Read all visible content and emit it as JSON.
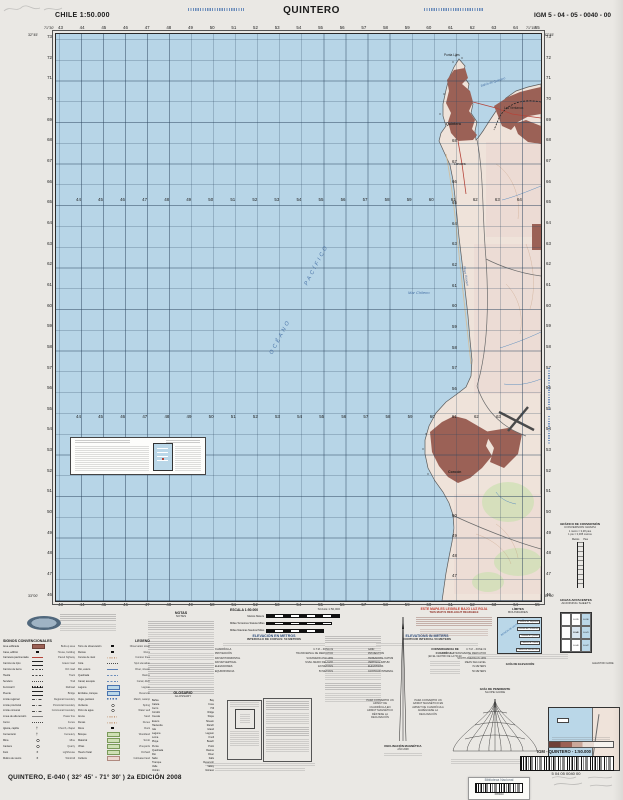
{
  "header": {
    "left": "CHILE  1:50.000",
    "title": "QUINTERO",
    "right": "IGM 5 - 04 - 05 - 0040 - 00"
  },
  "corners": {
    "lon_w": "71°30'",
    "lon_e": "71°15'",
    "lat_n": "32°45'",
    "lat_s": "33°00'"
  },
  "grid": {
    "top": [
      "43",
      "44",
      "45",
      "46",
      "47",
      "48",
      "49",
      "50",
      "51",
      "52",
      "53",
      "54",
      "55",
      "56",
      "57",
      "58",
      "59",
      "60",
      "61",
      "62",
      "63",
      "64",
      "65"
    ],
    "bottom": [
      "43",
      "44",
      "45",
      "46",
      "47",
      "48",
      "49",
      "50",
      "51",
      "52",
      "53",
      "54",
      "55",
      "56",
      "57",
      "58",
      "59",
      "60",
      "61",
      "62",
      "63",
      "64",
      "65"
    ],
    "left": [
      "73",
      "72",
      "71",
      "70",
      "69",
      "68",
      "67",
      "66",
      "65",
      "64",
      "63",
      "62",
      "61",
      "60",
      "59",
      "58",
      "57",
      "56",
      "55",
      "54",
      "53",
      "52",
      "51",
      "50",
      "49",
      "48",
      "47",
      "46"
    ],
    "right": [
      "73",
      "72",
      "71",
      "70",
      "69",
      "68",
      "67",
      "66",
      "65",
      "64",
      "63",
      "62",
      "61",
      "60",
      "59",
      "58",
      "57",
      "56",
      "55",
      "54",
      "53",
      "52",
      "51",
      "50",
      "49",
      "48",
      "47",
      "46"
    ],
    "inner_row1": [
      "44",
      "45",
      "46",
      "47",
      "48",
      "49",
      "50",
      "51",
      "52",
      "53",
      "54",
      "55",
      "56",
      "57",
      "58",
      "59",
      "60",
      "61",
      "62",
      "63",
      "64"
    ],
    "inner_row2": [
      "44",
      "45",
      "46",
      "47",
      "48",
      "49",
      "50",
      "51",
      "52",
      "53",
      "54",
      "55",
      "56",
      "57",
      "58",
      "59",
      "60",
      "61",
      "62",
      "63"
    ],
    "inner_col_a": [
      "68",
      "67",
      "66",
      "65",
      "64",
      "63",
      "62",
      "61",
      "60",
      "59",
      "58",
      "57",
      "56"
    ],
    "inner_col_b": [
      "50",
      "49",
      "48",
      "47"
    ]
  },
  "map_labels": [
    {
      "t": "OCÉANO",
      "cls": "lbl-ocean",
      "style": "left:205px;top:300px;transform:rotate(-62deg);"
    },
    {
      "t": "PACÍFICO",
      "cls": "lbl-ocean",
      "style": "left:238px;top:228px;transform:rotate(-62deg);"
    },
    {
      "t": "Mar Chileno",
      "cls": "lbl-sea",
      "style": "left:352px;top:256px;"
    },
    {
      "t": "Punta Liles",
      "cls": "",
      "style": "left:388px;top:19px;"
    },
    {
      "t": "Bahía de Quintero",
      "cls": "lbl-bay",
      "style": "left:424px;top:46px;transform:rotate(-18deg);"
    },
    {
      "t": "Quintero",
      "cls": "lbl-town",
      "style": "left:390px;top:88px;"
    },
    {
      "t": "Las Ventanas",
      "cls": "",
      "style": "left:448px;top:72px;"
    },
    {
      "t": "Loncura",
      "cls": "",
      "style": "left:398px;top:128px;"
    },
    {
      "t": "Playa Ritoque",
      "cls": "lbl-bay",
      "style": "left:400px;top:240px;transform:rotate(80deg);"
    },
    {
      "t": "Concón",
      "cls": "lbl-town",
      "style": "left:392px;top:436px;"
    }
  ],
  "colors": {
    "ocean": "#b7d5e7",
    "land": "#efe3da",
    "urban": "#9b6156",
    "green": "#cfe0b5",
    "red_note": "#c23b2e",
    "blue_text": "#4a74b0"
  },
  "notas": {
    "es": "NOTAS",
    "en": "NOTES"
  },
  "scale": {
    "es": "ESCALA 1:50.000",
    "en": "SCALE 1:50,000",
    "bar1": "Metros   Meters",
    "bar2": "Millas Terrestres   Statute Miles",
    "bar3": "Millas Náuticas   Nautical Miles"
  },
  "elev": {
    "es": "ELEVACIÓN EN METROS",
    "en": "ELEVATIONS IN METERS",
    "int_es": "INTERVALO DE CURVAS: 50 METROS",
    "int_en": "CONTOUR INTERVAL 50 METERS"
  },
  "tech_es": [
    {
      "k": "CUADRÍCULA",
      "v": "U.T.M. - ZONA 19"
    },
    {
      "k": "PROYECCIÓN",
      "v": "TRANSVERSAL DE MERCATOR"
    },
    {
      "k": "DATUM HORIZONTAL",
      "v": "SUDAMERICANO 1969"
    },
    {
      "k": "DATUM VERTICAL",
      "v": "NIVEL MEDIO DEL MAR"
    },
    {
      "k": "ELEVACIONES",
      "v": "EN METROS"
    },
    {
      "k": "EQUIDISTANCIA",
      "v": "50 METROS"
    }
  ],
  "tech_en": [
    {
      "k": "GRID",
      "v": "U.T.M. - ZONE 19"
    },
    {
      "k": "PROJECTION",
      "v": "TRANSVERSE MERCATOR"
    },
    {
      "k": "HORIZONTAL DATUM",
      "v": "SOUTH AMERICAN 1969"
    },
    {
      "k": "VERTICAL DATUM",
      "v": "MEAN SEA LEVEL"
    },
    {
      "k": "ELEVATIONS",
      "v": "IN METERS"
    },
    {
      "k": "CONTOUR INTERVAL",
      "v": "50 METERS"
    }
  ],
  "legend": {
    "es": "SIGNOS CONVENCIONALES",
    "en": "LEGEND",
    "col1": [
      {
        "l": "Área edificada",
        "s": "sy-urb",
        "r": "Built-up area"
      },
      {
        "l": "Casa, edificio",
        "s": "sy-blk",
        "r": "House, building"
      },
      {
        "l": "Carretera pavimentada",
        "s": "sy-red",
        "r": "Paved highway"
      },
      {
        "l": "Camino de ripio",
        "s": "sy-dual",
        "r": "Gravel road"
      },
      {
        "l": "Camino de tierra",
        "s": "sy-dash",
        "r": "Dirt road"
      },
      {
        "l": "Huella",
        "s": "sy-dash",
        "r": "Track"
      },
      {
        "l": "Sendero",
        "s": "sy-dot",
        "r": "Trail"
      },
      {
        "l": "Ferrocarril",
        "s": "sy-rail",
        "r": "Railroad"
      },
      {
        "l": "Puente",
        "s": "sy-dual",
        "r": "Bridge"
      },
      {
        "l": "Límite regional",
        "s": "sy-bound",
        "r": "Regional boundary"
      },
      {
        "l": "Límite provincial",
        "s": "sy-bound",
        "r": "Provincial boundary"
      },
      {
        "l": "Límite comunal",
        "s": "sy-bound",
        "r": "Communal boundary"
      },
      {
        "l": "Línea de alta tensión",
        "s": "sy-power",
        "r": "Power line"
      },
      {
        "l": "Cerco",
        "s": "sy-dot",
        "r": "Fence"
      },
      {
        "l": "Iglesia, capilla",
        "s": "sy-cross",
        "r": "Church, chapel"
      },
      {
        "l": "Cementerio",
        "s": "sy-cross",
        "r": "Cemetery"
      },
      {
        "l": "Mina",
        "s": "sy-circ",
        "r": "Mine"
      },
      {
        "l": "Cantera",
        "s": "sy-circ",
        "r": "Quarry"
      },
      {
        "l": "Faro",
        "s": "sy-star",
        "r": "Lighthouse"
      },
      {
        "l": "Molino de viento",
        "s": "sy-star",
        "r": "Windmill"
      }
    ],
    "col2": [
      {
        "l": "Torre de observación",
        "s": "sy-blk",
        "r": "Observation tower"
      },
      {
        "l": "Ruinas",
        "s": "sy-blk",
        "r": "Ruins"
      },
      {
        "l": "Curvas de nivel",
        "s": "sy-sand",
        "r": "Contour lines"
      },
      {
        "l": "Cota",
        "s": "sy-dot",
        "r": "Spot elevation"
      },
      {
        "l": "Río, estero",
        "s": "sy-blue",
        "r": "River, stream"
      },
      {
        "l": "Quebrada",
        "s": "sy-bldash",
        "r": "Ravine"
      },
      {
        "l": "Canal, acequia",
        "s": "sy-bldash",
        "r": "Canal, ditch"
      },
      {
        "l": "Laguna",
        "s": "sy-lake",
        "r": "Lagoon"
      },
      {
        "l": "Embalse, tranque",
        "s": "sy-lake",
        "r": "Reservoir"
      },
      {
        "l": "Vega, pantano",
        "s": "sy-marsh",
        "r": "Marsh, swamp"
      },
      {
        "l": "Vertiente",
        "s": "sy-circ",
        "r": "Spring"
      },
      {
        "l": "Pozo de agua",
        "s": "sy-circ",
        "r": "Water well"
      },
      {
        "l": "Arena",
        "s": "sy-sand",
        "r": "Sand"
      },
      {
        "l": "Dunas",
        "s": "sy-sand",
        "r": "Dunes"
      },
      {
        "l": "Roca",
        "s": "sy-blk",
        "r": "Rock"
      },
      {
        "l": "Bosque",
        "s": "sy-green",
        "r": "Woodland"
      },
      {
        "l": "Matorral",
        "s": "sy-green",
        "r": "Scrub"
      },
      {
        "l": "Viñas",
        "s": "sy-green",
        "r": "Vineyards"
      },
      {
        "l": "Huerto frutal",
        "s": "sy-green",
        "r": "Orchard"
      },
      {
        "l": "Cultivos",
        "s": "sy-pink",
        "r": "Cultivated land"
      }
    ]
  },
  "glossary": {
    "es": "GLOSARIO",
    "en": "GLOSSARY",
    "pairs": [
      {
        "es": "Bahía",
        "en": "Bay"
      },
      {
        "es": "Caleta",
        "en": "Cove"
      },
      {
        "es": "Cerro",
        "en": "Hill"
      },
      {
        "es": "Cordón",
        "en": "Ridge"
      },
      {
        "es": "Cuesta",
        "en": "Slope"
      },
      {
        "es": "Estero",
        "en": "Stream"
      },
      {
        "es": "Hacienda",
        "en": "Ranch"
      },
      {
        "es": "Isla",
        "en": "Island"
      },
      {
        "es": "Laguna",
        "en": "Lagoon"
      },
      {
        "es": "Loma",
        "en": "Knoll"
      },
      {
        "es": "Playa",
        "en": "Beach"
      },
      {
        "es": "Punta",
        "en": "Point"
      },
      {
        "es": "Quebrada",
        "en": "Ravine"
      },
      {
        "es": "Río",
        "en": "River"
      },
      {
        "es": "Salto",
        "en": "Falls"
      },
      {
        "es": "Tranque",
        "en": "Reservoir"
      },
      {
        "es": "Valle",
        "en": "Valley"
      },
      {
        "es": "Volcán",
        "en": "Volcano"
      }
    ]
  },
  "red_note": {
    "es": "ESTE MAPA ES LEGIBLE BAJO LUZ ROJA",
    "en": "THIS MAP IS RED-LIGHT READABLE"
  },
  "convergencia": {
    "t": "CONVERGENCIA DE CUADRÍCULA",
    "s": "(EN EL CENTRO DE LA HOJA)"
  },
  "declinacion": {
    "t": "DECLINACIÓN MAGNÉTICA",
    "s": "AÑO 2008"
  },
  "azimut": {
    "left": "PARA CONVERTIR UN AZIMUT DE CUADRÍCULA EN AZIMUT MAGNÉTICO RÉSTESE LA DECLINACIÓN",
    "right": "PARA CONVERTIR UN AZIMUT MAGNÉTICO EN AZIMUT DE CUADRÍCULA AGRÉGUESE LA DECLINACIÓN"
  },
  "slope": {
    "es": "GUÍA DE PENDIENTE",
    "en": "SLOPE GUIDE"
  },
  "limites": {
    "es": "LÍMITES",
    "en": "BOUNDARIES",
    "region": "REGIÓN DE VALPARAÍSO",
    "items": [
      "Provincia de Valparaíso",
      "Comuna de Puchuncaví",
      "Comuna de Quintero",
      "Comuna de Concón",
      "Comuna de Viña del Mar"
    ]
  },
  "hojas": {
    "es": "HOJAS ADYACENTES",
    "en": "ADJOINING SHEETS",
    "cells": [
      "",
      "E-035",
      "E-036",
      "",
      "E-040",
      "E-041",
      "",
      "E-046",
      "E-047"
    ],
    "current_index": 4
  },
  "conversion": {
    "es": "GRÁFICO DE CONVERSIÓN",
    "en": "CONVERSION GRAPH",
    "l1": "1 metro = 3,28 pies",
    "l2": "1 pie = 0,305 metros",
    "metros": "Metros",
    "pies": "Pies"
  },
  "elevguide": {
    "es": "GUÍA DE ELEVACIÓN",
    "en": "ELEVATION GUIDE"
  },
  "km_bar": {
    "km": "Km",
    "label": "IGM   - QUINTERO -   1:50.000",
    "digits": "5    04    05    0040    00"
  },
  "stamp": {
    "name": "Biblioteca Nacional",
    "number": "1565040"
  },
  "footer": {
    "sheet": "QUINTERO, E-040 ( 32° 45' - 71° 30' ) 2a EDICIÓN 2008"
  }
}
